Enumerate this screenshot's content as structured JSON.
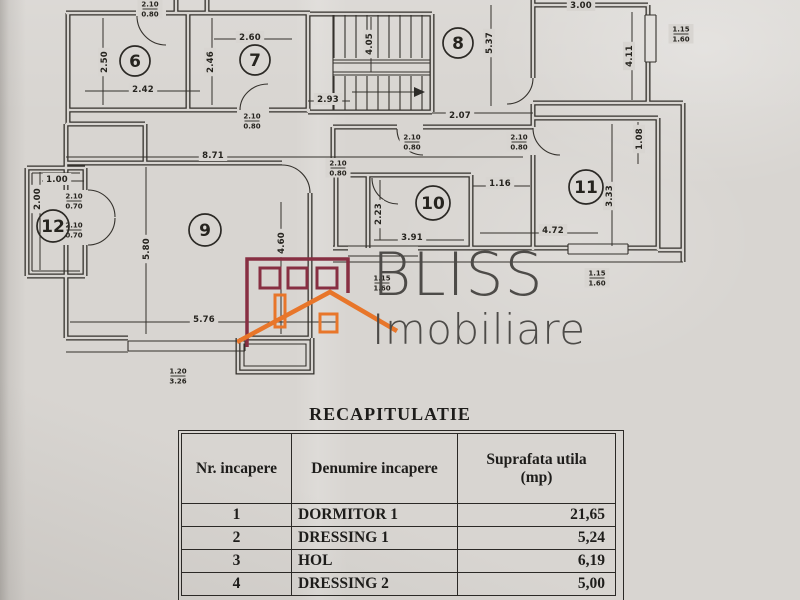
{
  "paper": {
    "bg": "#d8d5d1",
    "line": "#34312c"
  },
  "logo": {
    "name": "BLISS",
    "subtitle": "Imobiliare",
    "text_color": "#4d4b48",
    "house_outline": "#872f42",
    "house_accent": "#e8762a"
  },
  "plan": {
    "room_circles": [
      {
        "n": "6",
        "x": 135,
        "y": 61,
        "r": 15
      },
      {
        "n": "7",
        "x": 255,
        "y": 60,
        "r": 15
      },
      {
        "n": "8",
        "x": 458,
        "y": 43,
        "r": 15
      },
      {
        "n": "9",
        "x": 205,
        "y": 230,
        "r": 16
      },
      {
        "n": "10",
        "x": 433,
        "y": 203,
        "r": 17
      },
      {
        "n": "11",
        "x": 586,
        "y": 187,
        "r": 17
      },
      {
        "n": "12",
        "x": 53,
        "y": 226,
        "r": 16
      }
    ],
    "dim_labels": [
      {
        "t": "2.50",
        "x": 104,
        "y": 62,
        "rot": true
      },
      {
        "t": "2.42",
        "x": 143,
        "y": 89,
        "rot": false
      },
      {
        "t": "2.60",
        "x": 250,
        "y": 37,
        "rot": false
      },
      {
        "t": "2.46",
        "x": 210,
        "y": 62,
        "rot": true
      },
      {
        "t": "4.05",
        "x": 369,
        "y": 44,
        "rot": true
      },
      {
        "t": "2.93",
        "x": 328,
        "y": 99,
        "rot": false
      },
      {
        "t": "5.37",
        "x": 489,
        "y": 43,
        "rot": true
      },
      {
        "t": "2.07",
        "x": 460,
        "y": 115,
        "rot": false
      },
      {
        "t": "3.00",
        "x": 581,
        "y": 5,
        "rot": false
      },
      {
        "t": "4.11",
        "x": 629,
        "y": 56,
        "rot": true
      },
      {
        "t": "8.71",
        "x": 213,
        "y": 155,
        "rot": false
      },
      {
        "t": "1.00",
        "x": 57,
        "y": 179,
        "rot": false
      },
      {
        "t": "2.00",
        "x": 37,
        "y": 199,
        "rot": true
      },
      {
        "t": "5.80",
        "x": 146,
        "y": 249,
        "rot": true
      },
      {
        "t": "4.60",
        "x": 281,
        "y": 243,
        "rot": true
      },
      {
        "t": "5.76",
        "x": 204,
        "y": 319,
        "rot": false
      },
      {
        "t": "2.23",
        "x": 378,
        "y": 214,
        "rot": true
      },
      {
        "t": "3.91",
        "x": 412,
        "y": 237,
        "rot": false
      },
      {
        "t": "1.16",
        "x": 500,
        "y": 183,
        "rot": false
      },
      {
        "t": "3.33",
        "x": 609,
        "y": 196,
        "rot": true
      },
      {
        "t": "1.08",
        "x": 639,
        "y": 139,
        "rot": true
      },
      {
        "t": "4.72",
        "x": 553,
        "y": 230,
        "rot": false
      }
    ],
    "opening_labels": [
      {
        "top": "2.10",
        "bot": "0.80",
        "x": 150,
        "y": 8
      },
      {
        "top": "2.10",
        "bot": "0.80",
        "x": 252,
        "y": 120
      },
      {
        "top": "2.10",
        "bot": "0.80",
        "x": 338,
        "y": 167
      },
      {
        "top": "2.10",
        "bot": "0.80",
        "x": 412,
        "y": 141
      },
      {
        "top": "2.10",
        "bot": "0.80",
        "x": 519,
        "y": 141
      },
      {
        "top": "2.10",
        "bot": "0.70",
        "x": 74,
        "y": 200
      },
      {
        "top": "2.10",
        "bot": "0.70",
        "x": 74,
        "y": 229
      },
      {
        "top": "1.15",
        "bot": "1.60",
        "x": 681,
        "y": 33
      },
      {
        "top": "1.15",
        "bot": "1.60",
        "x": 597,
        "y": 277
      },
      {
        "top": "1.15",
        "bot": "1.60",
        "x": 382,
        "y": 282
      },
      {
        "top": "1.20",
        "bot": "3.26",
        "x": 178,
        "y": 375
      }
    ]
  },
  "recap": {
    "title": "RECAPITULATIE",
    "col1": "Nr. incapere",
    "col2": "Denumire incapere",
    "col3a": "Suprafata utila",
    "col3b": "(mp)",
    "rows": [
      {
        "nr": "1",
        "name": "DORMITOR 1",
        "area": "21,65"
      },
      {
        "nr": "2",
        "name": "DRESSING 1",
        "area": "5,24"
      },
      {
        "nr": "3",
        "name": "HOL",
        "area": "6,19"
      },
      {
        "nr": "4",
        "name": "DRESSING 2",
        "area": "5,00"
      }
    ]
  }
}
